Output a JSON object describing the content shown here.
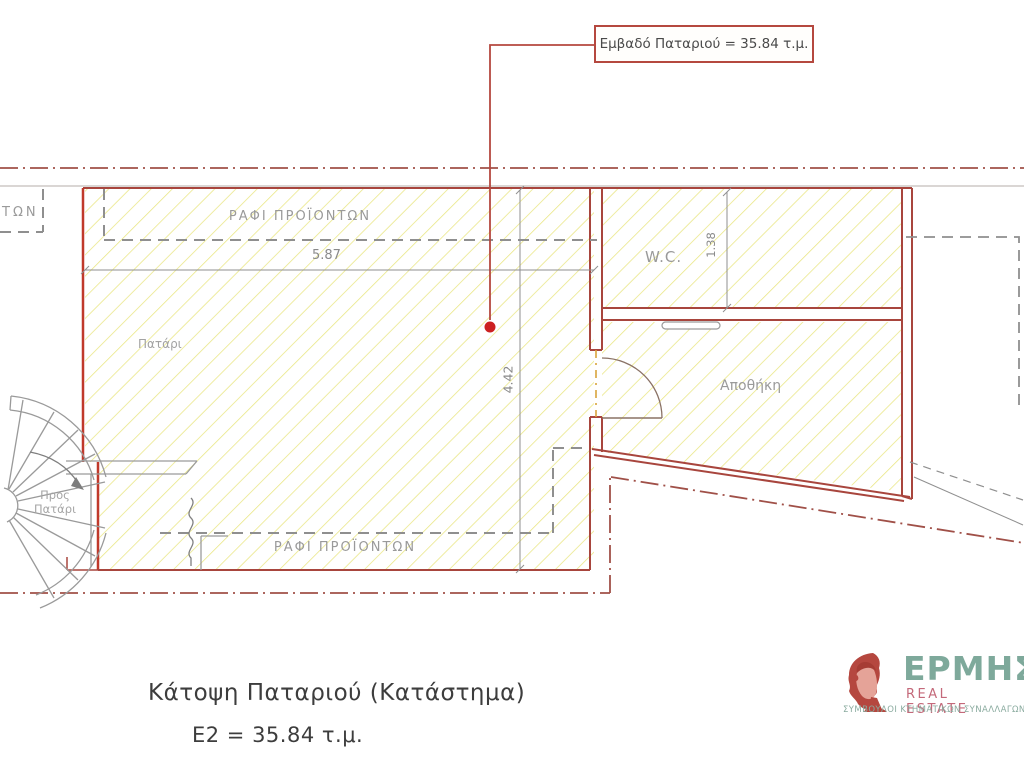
{
  "annotation": {
    "text": "Εμβαδό Παταριού = 35.84 τ.μ."
  },
  "labels": {
    "shelves_top": "ΡΑΦΙ ΠΡΟΪΟΝΤΩΝ",
    "shelves_bottom": "ΡΑΦΙ ΠΡΟΪΟΝΤΩΝ",
    "shelves_partial_left": "ΤΩΝ",
    "room_patari": "Πατάρι",
    "room_wc": "W.C.",
    "room_storage": "Αποθήκη",
    "to_loft": "Προς\nΠατάρι"
  },
  "dimensions": {
    "room_width_m": "5.87",
    "room_height_m": "4.42",
    "wc_width_m": "1.38"
  },
  "title": {
    "line1": "Κάτοψη Παταριού (Κατάστημα)",
    "line2": "Ε2 = 35.84 τ.μ."
  },
  "logo": {
    "brand": "ΕΡΜΗΣ",
    "subtitle": "REAL ESTATE",
    "tagline": "ΣΥΜΒΟΥΛΟΙ ΚΤΗΜΑΤΙΚΩΝ ΣΥΝΑΛΛΑΓΩΝ"
  },
  "colors": {
    "wall_red": "#a8453d",
    "accent_red": "#c0392b",
    "hatch_yellow": "#e9e682",
    "label_gray": "#9a9a9a",
    "logo_teal": "#7ea99b",
    "logo_pink": "#c4697a"
  }
}
